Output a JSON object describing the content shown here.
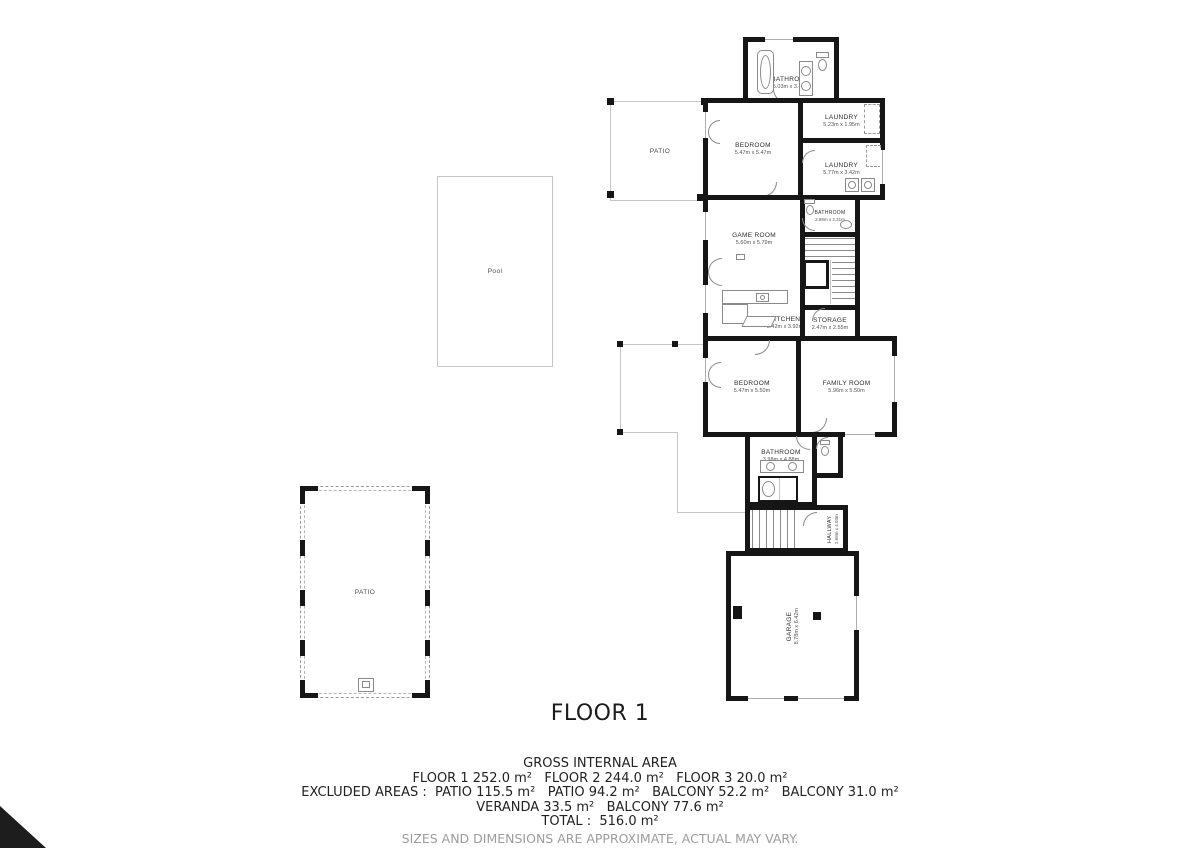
{
  "title": "FLOOR 1",
  "rooms": {
    "bathroom_top": {
      "name": "BATHROOM",
      "dims": "5.03m x 3.42m"
    },
    "bedroom_top": {
      "name": "BEDROOM",
      "dims": "5.47m x 5.47m"
    },
    "laundry_small": {
      "name": "LAUNDRY",
      "dims": "5.23m x 1.95m"
    },
    "laundry_large": {
      "name": "LAUNDRY",
      "dims": "5.77m x 3.42m"
    },
    "game_room": {
      "name": "GAME ROOM",
      "dims": "5.60m x 5.79m"
    },
    "bathroom_small": {
      "name": "BATHROOM",
      "dims": "2.98m x 2.31m"
    },
    "kitchen": {
      "name": "KITCHEN",
      "dims": "5.42m x 3.92m"
    },
    "storage": {
      "name": "STORAGE",
      "dims": "2.47m x 2.55m"
    },
    "bedroom_mid": {
      "name": "BEDROOM",
      "dims": "5.47m x 5.50m"
    },
    "family_room": {
      "name": "FAMILY ROOM",
      "dims": "5.96m x 5.50m"
    },
    "bathroom_mid": {
      "name": "BATHROOM",
      "dims": "3.98m x 4.88m"
    },
    "hallway": {
      "name": "HALLWAY",
      "dims": "2.68m x 4.03m"
    },
    "garage": {
      "name": "GARAGE",
      "dims": "8.78m x 6.42m"
    },
    "pool": {
      "name": "Pool"
    },
    "patio_top": {
      "name": "PATIO"
    },
    "patio_bottom": {
      "name": "PATIO"
    }
  },
  "footer": {
    "heading": "GROSS INTERNAL AREA",
    "lines": [
      "FLOOR 1 252.0 m²   FLOOR 2 244.0 m²   FLOOR 3 20.0 m²",
      "EXCLUDED AREAS :  PATIO 115.5 m²   PATIO 94.2 m²   BALCONY 52.2 m²   BALCONY 31.0 m²",
      "VERANDA 33.5 m²   BALCONY 77.6 m²",
      "TOTAL :  516.0 m²"
    ],
    "disclaimer": "SIZES AND DIMENSIONS ARE APPROXIMATE, ACTUAL MAY VARY."
  },
  "colors": {
    "wall": "#161616",
    "light_line": "#c6c6c6",
    "fixture_line": "#8a8a8a",
    "disclaimer_text": "#9c9c9c"
  },
  "icons": {
    "bathtub": "rounded-rect-with-oval",
    "toilet": "tank-and-bowl",
    "sink": "circle",
    "washer": "square-with-circle",
    "stairs": "parallel-lines",
    "door": "quarter-arc"
  }
}
